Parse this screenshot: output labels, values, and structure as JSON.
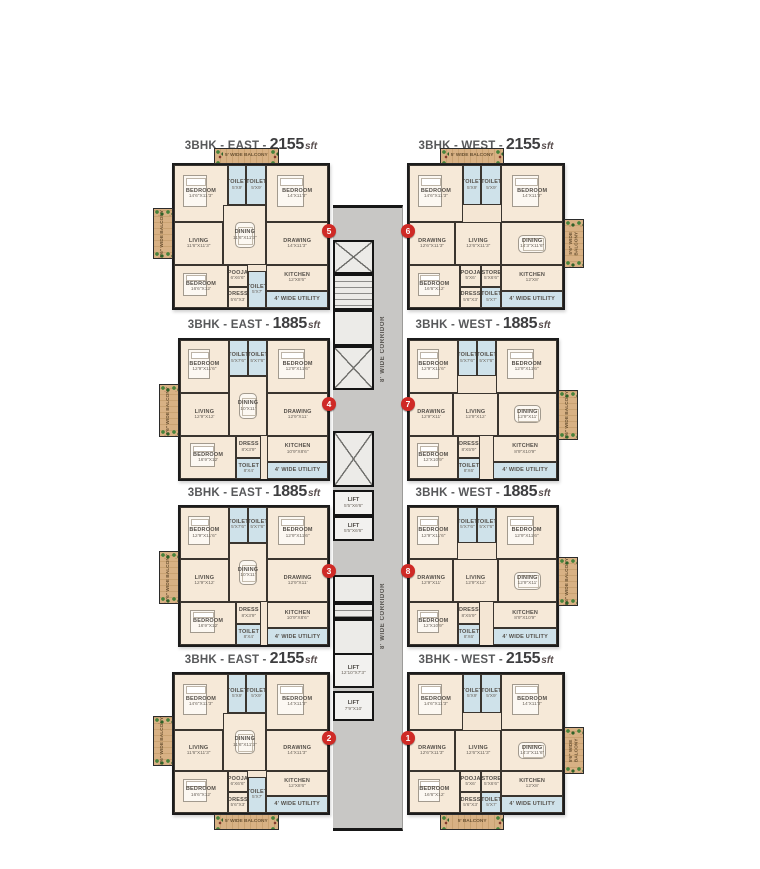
{
  "page_title": "Typical Floor Plan",
  "colors": {
    "badge_red": "#cf2a26",
    "wall_black": "#1c1c1c",
    "corridor_gray": "#c8c7c5",
    "room_beige": "#f6e9d8",
    "toilet_blue": "#cfe2ea",
    "balcony_wood": "#d8b184",
    "plant_green": "#47823b",
    "title_gray": "#57585a"
  },
  "corridor": {
    "box": {
      "left": 333,
      "top": 205,
      "width": 70,
      "height": 626
    },
    "width_label": "8' WIDE CORRIDOR",
    "label_positions": [
      {
        "top": 103,
        "height": 75
      },
      {
        "top": 370,
        "height": 75
      }
    ],
    "segments": [
      {
        "type": "x",
        "top": 32,
        "h": 34
      },
      {
        "type": "stairs",
        "top": 66,
        "h": 36
      },
      {
        "type": "open",
        "top": 102,
        "h": 36
      },
      {
        "type": "x",
        "top": 138,
        "h": 44
      },
      {
        "type": "x",
        "top": 223,
        "h": 56
      },
      {
        "type": "lift",
        "label": "LIFT",
        "dims": "5'5\"X6'6\"",
        "top": 282,
        "h": 26
      },
      {
        "type": "lift",
        "label": "LIFT",
        "dims": "5'5\"X6'6\"",
        "top": 308,
        "h": 25
      },
      {
        "type": "open",
        "top": 367,
        "h": 28
      },
      {
        "type": "stairs",
        "top": 395,
        "h": 16
      },
      {
        "type": "open",
        "top": 411,
        "h": 36
      },
      {
        "type": "lift",
        "label": "LIFT",
        "dims": "12'10\"X7'3\"",
        "top": 445,
        "h": 35
      },
      {
        "type": "lift",
        "label": "LIFT",
        "dims": "7'9\"X10'",
        "top": 483,
        "h": 30
      }
    ]
  },
  "plans": {
    "A_east": {
      "side_balcony": {
        "side": "left",
        "y": 30,
        "h": 36,
        "label": "5'6\" WIDE BALCONY"
      },
      "v_balcony_geom": {
        "x": 26,
        "w": 42
      },
      "rooms": [
        {
          "key": "bedroom1",
          "name": "BEDROOM",
          "dims": "14'6\"X11'3\"",
          "type": "room",
          "furn": "bed",
          "x": 0,
          "y": 0,
          "w": 35,
          "h": 40
        },
        {
          "key": "toilet1",
          "name": "TOILET",
          "dims": "5'X9'",
          "type": "wet",
          "x": 35,
          "y": 0,
          "w": 12,
          "h": 28
        },
        {
          "key": "toilet2",
          "name": "TOILET",
          "dims": "5'X9'",
          "type": "wet",
          "x": 47,
          "y": 0,
          "w": 13,
          "h": 28
        },
        {
          "key": "bedroom2",
          "name": "BEDROOM",
          "dims": "14'X11'3\"",
          "type": "room",
          "furn": "bed",
          "x": 60,
          "y": 0,
          "w": 40,
          "h": 40
        },
        {
          "key": "living",
          "name": "LIVING",
          "dims": "11'6\"X11'3\"",
          "type": "room",
          "x": 0,
          "y": 40,
          "w": 32,
          "h": 30
        },
        {
          "key": "dining",
          "name": "DINING",
          "dims": "11'6\"X11'3\"",
          "type": "room",
          "furn": "table",
          "x": 32,
          "y": 28,
          "w": 28,
          "h": 42
        },
        {
          "key": "drawing",
          "name": "DRAWING",
          "dims": "14'X11'3\"",
          "type": "room",
          "x": 60,
          "y": 40,
          "w": 40,
          "h": 30
        },
        {
          "key": "bedroom3",
          "name": "BEDROOM",
          "dims": "16'6\"X12'",
          "type": "room",
          "furn": "bed",
          "x": 0,
          "y": 70,
          "w": 35,
          "h": 30
        },
        {
          "key": "pooja",
          "name": "POOJA",
          "dims": "6'X6'6\"",
          "type": "room",
          "x": 35,
          "y": 70,
          "w": 13,
          "h": 15
        },
        {
          "key": "dress",
          "name": "DRESS",
          "dims": "5'6\"X3'",
          "type": "room",
          "x": 35,
          "y": 85,
          "w": 13,
          "h": 15
        },
        {
          "key": "toilet3",
          "name": "TOILET",
          "dims": "5'X7'",
          "type": "wet",
          "x": 48,
          "y": 74,
          "w": 12,
          "h": 26
        },
        {
          "key": "kitchen",
          "name": "KITCHEN",
          "dims": "12'X8'6\"",
          "type": "room",
          "x": 60,
          "y": 70,
          "w": 40,
          "h": 18
        },
        {
          "key": "utility",
          "name": "4' WIDE UTILITY",
          "dims": "",
          "type": "wet",
          "x": 60,
          "y": 88,
          "w": 40,
          "h": 12
        }
      ]
    },
    "A_west": {
      "side_balcony": {
        "side": "right",
        "y": 38,
        "h": 34,
        "label": "5'6\" WIDE BALCONY"
      },
      "v_balcony_geom": {
        "x": 20,
        "w": 42
      },
      "rooms": [
        {
          "key": "bedroom1",
          "name": "BEDROOM",
          "dims": "14'6\"X11'3\"",
          "type": "room",
          "furn": "bed",
          "x": 0,
          "y": 0,
          "w": 35,
          "h": 40
        },
        {
          "key": "toilet1",
          "name": "TOILET",
          "dims": "5'X9'",
          "type": "wet",
          "x": 35,
          "y": 0,
          "w": 12,
          "h": 28
        },
        {
          "key": "toilet2",
          "name": "TOILET",
          "dims": "5'X9'",
          "type": "wet",
          "x": 47,
          "y": 0,
          "w": 13,
          "h": 28
        },
        {
          "key": "bedroom2",
          "name": "BEDROOM",
          "dims": "14'X11'3\"",
          "type": "room",
          "furn": "bed",
          "x": 60,
          "y": 0,
          "w": 40,
          "h": 40
        },
        {
          "key": "drawing",
          "name": "DRAWING",
          "dims": "12'6\"X11'3\"",
          "type": "room",
          "x": 0,
          "y": 40,
          "w": 30,
          "h": 30
        },
        {
          "key": "living",
          "name": "LIVING",
          "dims": "12'6\"X11'3\"",
          "type": "room",
          "x": 30,
          "y": 40,
          "w": 30,
          "h": 30
        },
        {
          "key": "dining",
          "name": "DINING",
          "dims": "14'3\"X11'6\"",
          "type": "room",
          "furn": "table",
          "x": 60,
          "y": 40,
          "w": 40,
          "h": 30
        },
        {
          "key": "bedroom3",
          "name": "BEDROOM",
          "dims": "16'6\"X12'",
          "type": "room",
          "furn": "bed",
          "x": 0,
          "y": 70,
          "w": 33,
          "h": 30
        },
        {
          "key": "pooja",
          "name": "POOJA",
          "dims": "5'X6'",
          "type": "room",
          "x": 33,
          "y": 70,
          "w": 14,
          "h": 15
        },
        {
          "key": "store",
          "name": "STORE",
          "dims": "5'X6'6\"",
          "type": "room",
          "x": 47,
          "y": 70,
          "w": 13,
          "h": 15
        },
        {
          "key": "dress",
          "name": "DRESS",
          "dims": "5'6\"X3'",
          "type": "room",
          "x": 33,
          "y": 85,
          "w": 14,
          "h": 15
        },
        {
          "key": "toilet3",
          "name": "TOILET",
          "dims": "5'X7'",
          "type": "wet",
          "x": 47,
          "y": 85,
          "w": 13,
          "h": 15
        },
        {
          "key": "kitchen",
          "name": "KITCHEN",
          "dims": "12'X8'",
          "type": "room",
          "x": 60,
          "y": 70,
          "w": 40,
          "h": 18
        },
        {
          "key": "utility",
          "name": "4' WIDE UTILITY",
          "dims": "",
          "type": "wet",
          "x": 60,
          "y": 88,
          "w": 40,
          "h": 12
        }
      ]
    },
    "B_east": {
      "side_balcony": {
        "side": "left",
        "y": 32,
        "h": 38,
        "label": "5'6\" WIDE BALCONY"
      },
      "v_balcony_geom": null,
      "rooms": [
        {
          "key": "bedroom1",
          "name": "BEDROOM",
          "dims": "12'9\"X11'6\"",
          "type": "room",
          "furn": "bed",
          "x": 0,
          "y": 0,
          "w": 33,
          "h": 38
        },
        {
          "key": "toilet1",
          "name": "TOILET",
          "dims": "5'X7'6\"",
          "type": "wet",
          "x": 33,
          "y": 0,
          "w": 13,
          "h": 26
        },
        {
          "key": "toilet2",
          "name": "TOILET",
          "dims": "5'X7'6\"",
          "type": "wet",
          "x": 46,
          "y": 0,
          "w": 13,
          "h": 26
        },
        {
          "key": "bedroom2",
          "name": "BEDROOM",
          "dims": "12'9\"X11'6\"",
          "type": "room",
          "furn": "bed",
          "x": 59,
          "y": 0,
          "w": 41,
          "h": 38
        },
        {
          "key": "living",
          "name": "LIVING",
          "dims": "12'9\"X12'",
          "type": "room",
          "x": 0,
          "y": 38,
          "w": 33,
          "h": 31
        },
        {
          "key": "dining",
          "name": "DINING",
          "dims": "10'X11'",
          "type": "room",
          "furn": "table",
          "x": 33,
          "y": 26,
          "w": 26,
          "h": 43
        },
        {
          "key": "drawing",
          "name": "DRAWING",
          "dims": "12'9\"X11'",
          "type": "room",
          "x": 59,
          "y": 38,
          "w": 41,
          "h": 31
        },
        {
          "key": "bedroom3",
          "name": "BEDROOM",
          "dims": "16'9\"X12'",
          "type": "room",
          "furn": "bed",
          "x": 0,
          "y": 69,
          "w": 38,
          "h": 31
        },
        {
          "key": "dress",
          "name": "DRESS",
          "dims": "8'X3'9\"",
          "type": "room",
          "x": 38,
          "y": 69,
          "w": 17,
          "h": 16
        },
        {
          "key": "toilet3",
          "name": "TOILET",
          "dims": "8'X4'",
          "type": "wet",
          "x": 38,
          "y": 85,
          "w": 17,
          "h": 15
        },
        {
          "key": "kitchen",
          "name": "KITCHEN",
          "dims": "10'9\"X8'6\"",
          "type": "room",
          "x": 59,
          "y": 69,
          "w": 41,
          "h": 19
        },
        {
          "key": "utility",
          "name": "4' WIDE UTILITY",
          "dims": "",
          "type": "wet",
          "x": 59,
          "y": 88,
          "w": 41,
          "h": 12
        }
      ]
    },
    "B_west": {
      "side_balcony": {
        "side": "right",
        "y": 36,
        "h": 36,
        "label": "5'6\" WIDE BALCONY"
      },
      "v_balcony_geom": null,
      "rooms": [
        {
          "key": "bedroom1",
          "name": "BEDROOM",
          "dims": "12'9\"X11'6\"",
          "type": "room",
          "furn": "bed",
          "x": 0,
          "y": 0,
          "w": 33,
          "h": 38
        },
        {
          "key": "toilet1",
          "name": "TOILET",
          "dims": "5'X7'6\"",
          "type": "wet",
          "x": 33,
          "y": 0,
          "w": 13,
          "h": 26
        },
        {
          "key": "toilet2",
          "name": "TOILET",
          "dims": "5'X7'6\"",
          "type": "wet",
          "x": 46,
          "y": 0,
          "w": 13,
          "h": 26
        },
        {
          "key": "bedroom2",
          "name": "BEDROOM",
          "dims": "12'9\"X11'6\"",
          "type": "room",
          "furn": "bed",
          "x": 59,
          "y": 0,
          "w": 41,
          "h": 38
        },
        {
          "key": "drawing",
          "name": "DRAWING",
          "dims": "12'9\"X11'",
          "type": "room",
          "x": 0,
          "y": 38,
          "w": 30,
          "h": 31
        },
        {
          "key": "living",
          "name": "LIVING",
          "dims": "12'9\"X12'",
          "type": "room",
          "x": 30,
          "y": 38,
          "w": 30,
          "h": 31
        },
        {
          "key": "dining",
          "name": "DINING",
          "dims": "12'9\"X11'",
          "type": "room",
          "furn": "table",
          "x": 60,
          "y": 38,
          "w": 40,
          "h": 31
        },
        {
          "key": "bedroom3",
          "name": "BEDROOM",
          "dims": "12'X10'9\"",
          "type": "room",
          "furn": "bed",
          "x": 0,
          "y": 69,
          "w": 33,
          "h": 31
        },
        {
          "key": "dress",
          "name": "DRESS",
          "dims": "8'X5'9\"",
          "type": "room",
          "x": 33,
          "y": 69,
          "w": 15,
          "h": 16
        },
        {
          "key": "toilet3",
          "name": "TOILET",
          "dims": "8'X6'",
          "type": "wet",
          "x": 33,
          "y": 85,
          "w": 15,
          "h": 15
        },
        {
          "key": "kitchen",
          "name": "KITCHEN",
          "dims": "8'9\"X10'9\"",
          "type": "room",
          "x": 57,
          "y": 69,
          "w": 43,
          "h": 19
        },
        {
          "key": "utility",
          "name": "4' WIDE UTILITY",
          "dims": "",
          "type": "wet",
          "x": 57,
          "y": 88,
          "w": 43,
          "h": 12
        }
      ]
    }
  },
  "units": [
    {
      "badge": "5",
      "side": "east",
      "plan": "A_east",
      "title": {
        "prefix": "3BHK - EAST -",
        "area": "2155",
        "suffix": "sft"
      },
      "box": {
        "left": 172,
        "top": 163,
        "width": 158,
        "height": 147
      },
      "title_top": 136,
      "v_balcony": {
        "pos": "top",
        "label": "5' WIDE BALCONY"
      }
    },
    {
      "badge": "6",
      "side": "west",
      "plan": "A_west",
      "title": {
        "prefix": "3BHK - WEST -",
        "area": "2155",
        "suffix": "sft"
      },
      "box": {
        "left": 407,
        "top": 163,
        "width": 158,
        "height": 147
      },
      "title_top": 136,
      "v_balcony": {
        "pos": "top",
        "label": "5' WIDE BALCONY"
      }
    },
    {
      "badge": "4",
      "side": "east",
      "plan": "B_east",
      "title": {
        "prefix": "3BHK - EAST -",
        "area": "1885",
        "suffix": "sft"
      },
      "box": {
        "left": 178,
        "top": 338,
        "width": 152,
        "height": 143
      },
      "title_top": 315,
      "v_balcony": null
    },
    {
      "badge": "7",
      "side": "west",
      "plan": "B_west",
      "title": {
        "prefix": "3BHK - WEST -",
        "area": "1885",
        "suffix": "sft"
      },
      "box": {
        "left": 407,
        "top": 338,
        "width": 152,
        "height": 143
      },
      "title_top": 315,
      "v_balcony": null
    },
    {
      "badge": "3",
      "side": "east",
      "plan": "B_east",
      "title": {
        "prefix": "3BHK - EAST -",
        "area": "1885",
        "suffix": "sft"
      },
      "box": {
        "left": 178,
        "top": 505,
        "width": 152,
        "height": 142
      },
      "title_top": 483,
      "v_balcony": null
    },
    {
      "badge": "8",
      "side": "west",
      "plan": "B_west",
      "title": {
        "prefix": "3BHK - WEST -",
        "area": "1885",
        "suffix": "sft"
      },
      "box": {
        "left": 407,
        "top": 505,
        "width": 152,
        "height": 142
      },
      "title_top": 483,
      "v_balcony": null
    },
    {
      "badge": "2",
      "side": "east",
      "plan": "A_east",
      "title": {
        "prefix": "3BHK - EAST -",
        "area": "2155",
        "suffix": "sft"
      },
      "box": {
        "left": 172,
        "top": 672,
        "width": 158,
        "height": 143
      },
      "title_top": 650,
      "v_balcony": {
        "pos": "bottom",
        "label": "5' WIDE BALCONY"
      }
    },
    {
      "badge": "1",
      "side": "west",
      "plan": "A_west",
      "title": {
        "prefix": "3BHK - WEST -",
        "area": "2155",
        "suffix": "sft"
      },
      "box": {
        "left": 407,
        "top": 672,
        "width": 158,
        "height": 143
      },
      "title_top": 650,
      "v_balcony": {
        "pos": "bottom",
        "label": "5' BALCONY"
      }
    }
  ]
}
